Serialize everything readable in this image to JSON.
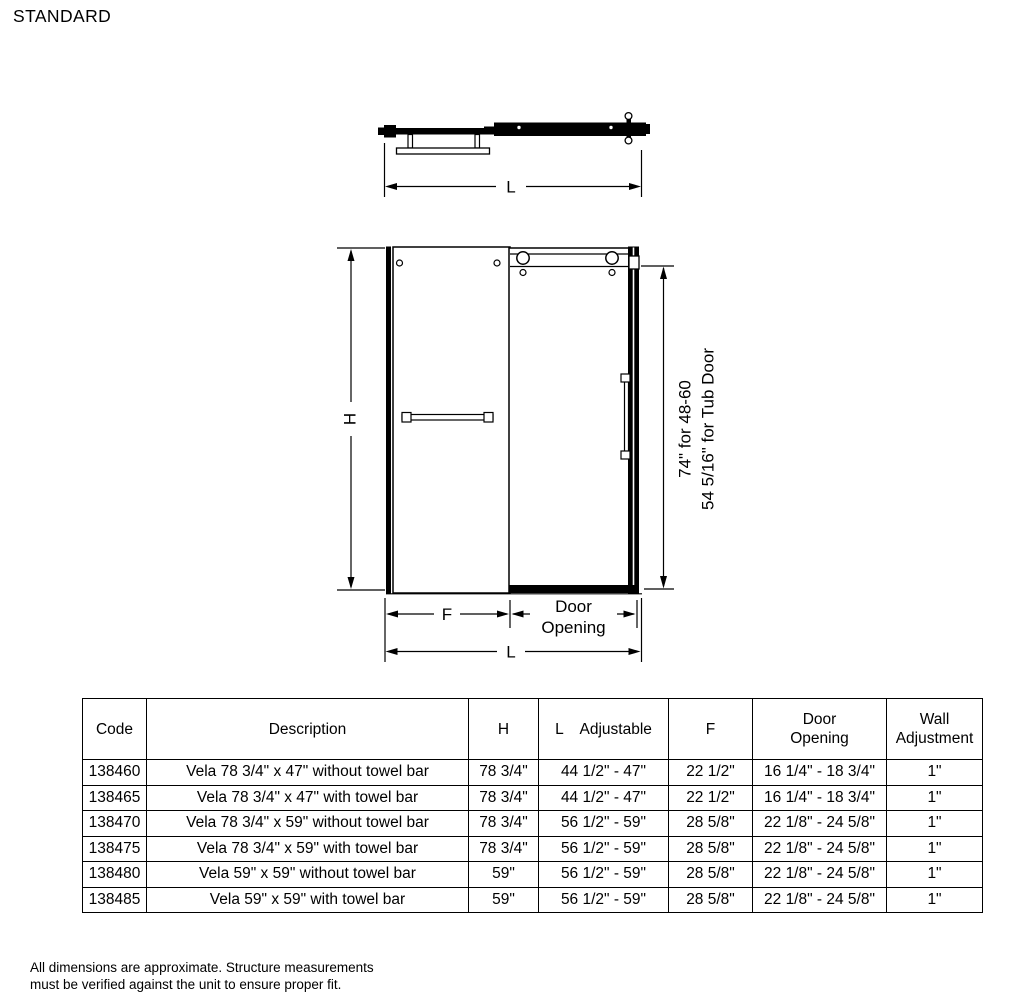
{
  "page": {
    "title": "STANDARD"
  },
  "drawing": {
    "top_view": {
      "length_label": "L"
    },
    "front_view": {
      "height_label": "H",
      "fixed_panel_label": "F",
      "door_opening_line1": "Door",
      "door_opening_line2": "Opening",
      "length_label": "L",
      "height_note_line1": "74\" for 48-60",
      "height_note_line2": "54 5/16\" for Tub Door"
    }
  },
  "spec_table": {
    "headers": [
      "Code",
      "Description",
      "H",
      "L    Adjustable",
      "F",
      "Door\nOpening",
      "Wall\nAdjustment"
    ],
    "rows": [
      [
        "138460",
        "Vela 78 3/4\" x 47\" without towel bar",
        "78 3/4\"",
        "44 1/2\" - 47\"",
        "22 1/2\"",
        "16 1/4\" - 18 3/4\"",
        "1\""
      ],
      [
        "138465",
        "Vela 78 3/4\" x 47\" with towel bar",
        "78 3/4\"",
        "44 1/2\" - 47\"",
        "22 1/2\"",
        "16 1/4\" - 18 3/4\"",
        "1\""
      ],
      [
        "138470",
        "Vela 78 3/4\" x 59\" without towel bar",
        "78 3/4\"",
        "56 1/2\" - 59\"",
        "28 5/8\"",
        "22 1/8\" - 24 5/8\"",
        "1\""
      ],
      [
        "138475",
        "Vela 78 3/4\" x 59\" with towel bar",
        "78 3/4\"",
        "56 1/2\" - 59\"",
        "28 5/8\"",
        "22 1/8\" - 24 5/8\"",
        "1\""
      ],
      [
        "138480",
        "Vela 59\" x 59\" without towel bar",
        "59\"",
        "56 1/2\" - 59\"",
        "28 5/8\"",
        "22 1/8\" - 24 5/8\"",
        "1\""
      ],
      [
        "138485",
        "Vela 59\" x 59\" with towel bar",
        "59\"",
        "56 1/2\" - 59\"",
        "28 5/8\"",
        "22 1/8\" - 24 5/8\"",
        "1\""
      ]
    ]
  },
  "footer": {
    "note": "All dimensions are approximate. Structure measurements\nmust be verified against the unit to ensure proper fit."
  }
}
